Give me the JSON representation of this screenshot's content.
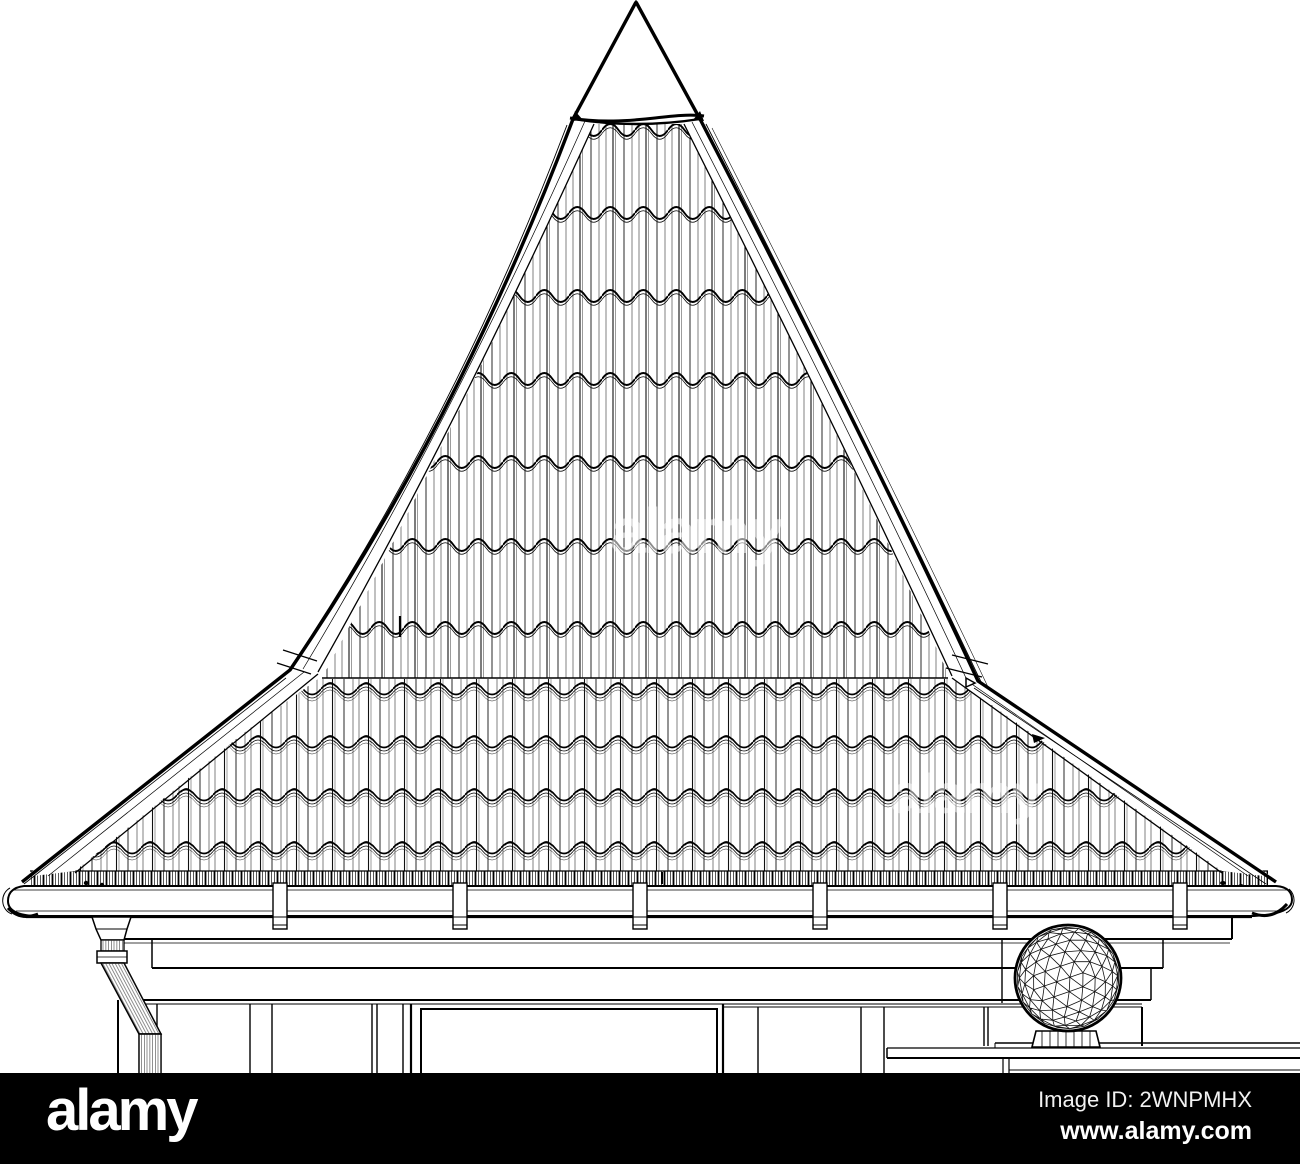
{
  "page": {
    "background_color": "#ffffff",
    "ink_color": "#000000"
  },
  "artwork": {
    "watermark_text": "alamy"
  },
  "footer": {
    "bar_color": "#000000",
    "text_color": "#ffffff",
    "logo_text": "alamy",
    "image_id_text": "Image ID: 2WNPMHX",
    "website_text": "www.alamy.com"
  }
}
